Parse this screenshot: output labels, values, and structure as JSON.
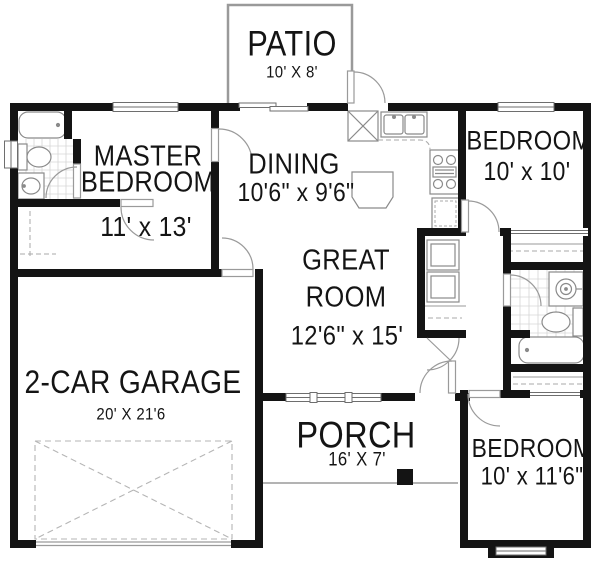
{
  "rooms": {
    "patio": {
      "name": "PATIO",
      "dims": "10' X 8'"
    },
    "master_bedroom": {
      "name_line1": "MASTER",
      "name_line2": "BEDROOM",
      "dims": "11' x 13'"
    },
    "dining": {
      "name": "DINING",
      "dims": "10'6\" x 9'6\""
    },
    "bedroom_top": {
      "name": "BEDROOM",
      "dims": "10' x 10'"
    },
    "great_room": {
      "name_line1": "GREAT",
      "name_line2": "ROOM",
      "dims": "12'6\" x 15'"
    },
    "garage": {
      "name": "2-CAR GARAGE",
      "dims": "20' X 21'6"
    },
    "porch": {
      "name": "PORCH",
      "dims": "16' X 7'"
    },
    "bedroom_bottom": {
      "name": "BEDROOM",
      "dims": "10' x 11'6\""
    }
  },
  "colors": {
    "wall": "#141414",
    "fixture_outline": "#8a8a8a",
    "door_swing": "#9a9a9a",
    "tile_grid": "#d6d6d6",
    "dashed_detail": "#aaaaaa",
    "background": "#ffffff"
  }
}
